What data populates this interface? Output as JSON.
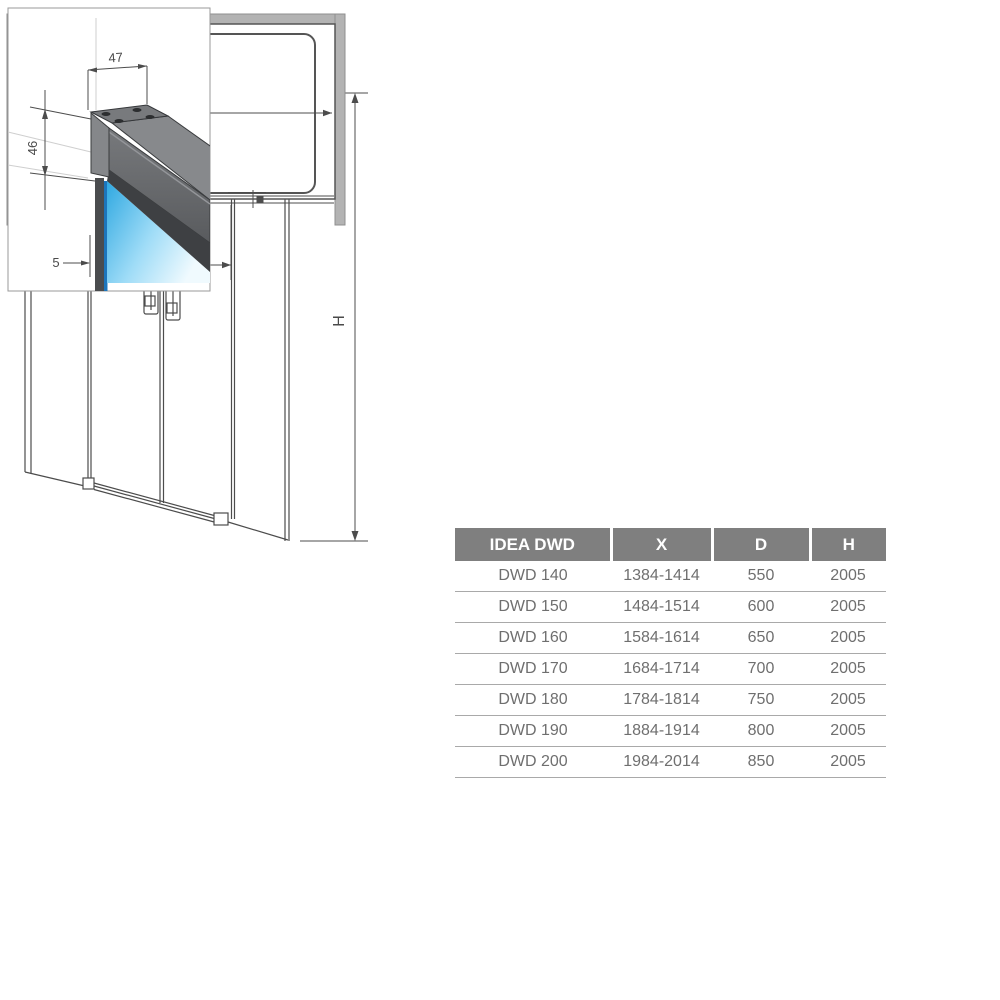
{
  "page": {
    "background": "#ffffff",
    "description": "shower door technical drawing sheet"
  },
  "views": {
    "front": {
      "h_dim_label": "H"
    },
    "top": {
      "x_dim_label": "X",
      "d_dim_label": "D"
    },
    "detail": {
      "width_dim_label": "47",
      "height_dim_label": "46",
      "glass_thickness_dim_label": "5"
    }
  },
  "colors": {
    "line": "#4c4c4c",
    "wall_gray": "#b3b3b3",
    "glass_blue": "#2fa8e1",
    "glass_blue_light": "#f0fafe",
    "glass_edge_blue": "#1c75bb",
    "profile_dark": "#3e4043",
    "profile_mid": "#6b6d70",
    "profile_light": "#87898c",
    "table_header_bg": "#7f7f7f",
    "table_header_text": "#ffffff",
    "table_body_text": "#6f6f6f",
    "table_rule": "#a9a9a9"
  },
  "table": {
    "headers": [
      "IDEA DWD",
      "X",
      "D",
      "H"
    ],
    "rows": [
      [
        "DWD 140",
        "1384-1414",
        "550",
        "2005"
      ],
      [
        "DWD 150",
        "1484-1514",
        "600",
        "2005"
      ],
      [
        "DWD 160",
        "1584-1614",
        "650",
        "2005"
      ],
      [
        "DWD 170",
        "1684-1714",
        "700",
        "2005"
      ],
      [
        "DWD 180",
        "1784-1814",
        "750",
        "2005"
      ],
      [
        "DWD 190",
        "1884-1914",
        "800",
        "2005"
      ],
      [
        "DWD 200",
        "1984-2014",
        "850",
        "2005"
      ]
    ]
  }
}
